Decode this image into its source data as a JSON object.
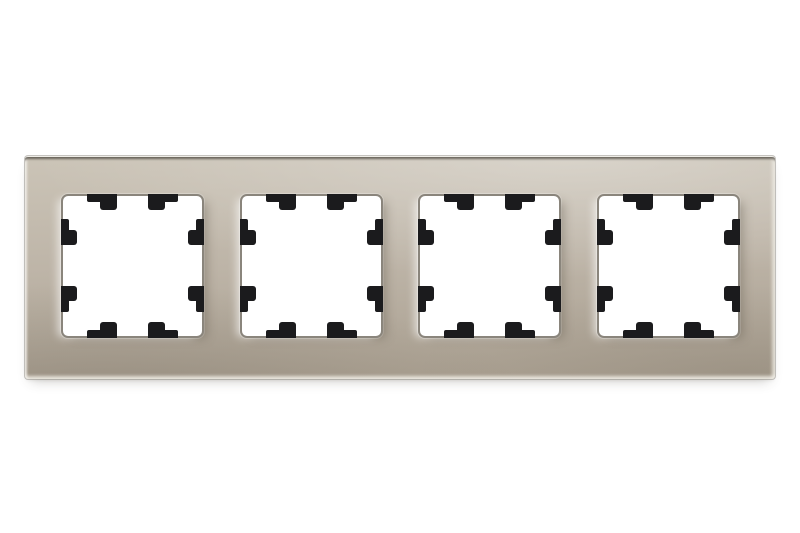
{
  "scene": {
    "description": "Product photograph of a horizontal 4-gang metallic champagne glass cover frame for light switches and socket outlets, with black plastic mounting clips visible in each square opening, on a plain white background",
    "background": "#ffffff"
  },
  "frame": {
    "gang_count": 4,
    "orientation": "horizontal",
    "clips_per_opening": 8,
    "colors": {
      "bg": "#ffffff",
      "champagne_light": "#cbc4b7",
      "champagne": "#bdb4a7",
      "champagne_dark": "#a89e8f",
      "window": "#ffffff",
      "window_border": "#8a857c",
      "clip": "#1b1b1d",
      "edge_highlight": "#efede7"
    },
    "layout": {
      "opening_pitch_px": 178.5,
      "first_opening_left_px": 36
    }
  }
}
